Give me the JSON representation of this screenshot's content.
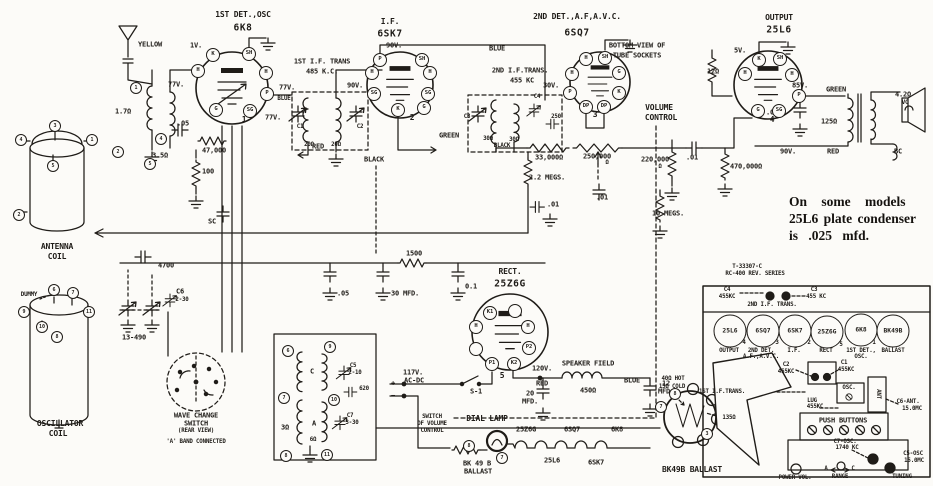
{
  "stages": {
    "det1": {
      "caption": "1ST DET.,OSC",
      "tube": "6K8",
      "num": "1"
    },
    "if1": {
      "caption": "I.F.",
      "tube": "6SK7",
      "num": "2"
    },
    "det2": {
      "caption": "2ND DET.,A.F,A.V.C.",
      "tube": "6SQ7",
      "num": "3"
    },
    "out": {
      "caption": "OUTPUT",
      "tube": "25L6",
      "num": "4"
    },
    "rect": {
      "caption": "RECT.",
      "tube": "25Z6G",
      "num": "5"
    }
  },
  "socket_note": {
    "l1": "BOTTOM VIEW OF",
    "l2": "TUBE SOCKETS"
  },
  "volts": {
    "v1": "1V.",
    "v5": "5V.",
    "v30": "30V.",
    "v77": "77V.",
    "v85": "85V.",
    "v90": "90V.",
    "v120": "120V."
  },
  "wires": {
    "yellow": "YELLOW",
    "blue": "BLUE",
    "red": "RED",
    "green": "GREEN",
    "black": "BLACK"
  },
  "parts": {
    "ant_prim": "1.7Ω",
    "ant_sec": "3.5Ω",
    "c_05": ".05",
    "r_47k": "47,000",
    "r_100": "100",
    "c_sc": "SC",
    "c_4700": "4700",
    "gang": "13-490",
    "c6": "C6",
    "c6_val": "2-30",
    "if1_name": "1ST I.F. TRANS",
    "if1_freq": "485 K.C.",
    "c1": "C1",
    "c2": "C2",
    "r_20": "20Ω",
    "if2_name": "2ND I.F.TRANS.",
    "if2_freq": "455 KC",
    "c3": "C3",
    "c4": "C4",
    "c_250": "250",
    "r_30": "30Ω",
    "r_33k": "33,000Ω",
    "pot": "250,000",
    "ohm": "Ω",
    "r_22m": "2.2 MEGS.",
    "c_01": ".01",
    "r_220k": "220,000",
    "r_10m": "10 MEGS.",
    "r_470k": "470,000Ω",
    "vol1": "VOLUME",
    "vol2": "CONTROL",
    "r_12": "12Ω",
    "c_035": ".035",
    "r_125": "125Ω",
    "vc_imp": "4.2Ω",
    "vc": "VC",
    "bc": "BC",
    "r_1500": "1500",
    "c_30mfd": "30 MFD.",
    "c_01b": "0.1",
    "field1": "SPEAKER FIELD",
    "field2": "450Ω",
    "c20_1": "20",
    "c20_2": "MFD.",
    "c12_1": "12",
    "c12_2": "MFD.",
    "s1": "S-1",
    "mains1": "117V.",
    "mains2": "AC-DC",
    "plus": "+",
    "minus": "−",
    "msw1": "SWITCH",
    "msw2": "OF VOLUME",
    "msw3": "CONTROL",
    "wind_c": "C",
    "wind_a": "A",
    "osc_3": "3Ω",
    "osc_6": "6Ω",
    "c5": "C5",
    "c5_val": "2-10",
    "c_620": "620",
    "c7": "C7",
    "c7_val": "3-30"
  },
  "wave": {
    "l1": "WAVE CHANGE",
    "l2": "SWITCH",
    "l3": "(REAR VIEW)",
    "l4": "'A' BAND CONNECTED"
  },
  "note": {
    "l1": "On some models",
    "l2": "25L6 plate condenser",
    "l3": "is .025 mfd."
  },
  "dial": {
    "label": "DIAL LAMP",
    "ballast1": "BK 49 B",
    "ballast2": "BALLAST",
    "pin_a": "8",
    "pin_b": "7"
  },
  "heater": [
    "25Z6G",
    "6SQ7",
    "6K8",
    "25L6",
    "6SK7"
  ],
  "ballast": {
    "hot": "40Ω HOT",
    "cold": "15Ω COLD",
    "res": "135Ω",
    "name": "BK49B BALLAST",
    "p7": "7",
    "p8": "8",
    "p3": "3"
  },
  "pins": {
    "det1": [
      "K",
      "SH",
      "H",
      "H",
      "P",
      "SG",
      "G"
    ],
    "if1": [
      "P",
      "SH",
      "H",
      "H",
      "SG",
      "SG",
      "K",
      "G"
    ],
    "det2": [
      "H",
      "SH",
      "H",
      "G",
      "P",
      "K",
      "DP",
      "DP"
    ],
    "out": [
      "K",
      "SH",
      "H",
      "H",
      "P",
      "G",
      "SG"
    ],
    "rect": [
      "K1",
      "H",
      "H",
      "P2",
      "P1",
      "K2"
    ]
  },
  "coil_pins": {
    "ant": [
      "1",
      "2",
      "4",
      "5"
    ],
    "osc": [
      "6",
      "9",
      "7",
      "10",
      "11",
      "8"
    ]
  },
  "pictorials": {
    "antenna": {
      "l1": "ANTENNA",
      "l2": "COIL",
      "pins": [
        "3",
        "4",
        "1",
        "5",
        "2"
      ]
    },
    "oscillator": {
      "l1": "OSCILLATOR",
      "l2": "COIL",
      "dummy": "DUMMY",
      "pins": [
        "6",
        "7",
        "9",
        "11",
        "10",
        "8"
      ]
    }
  },
  "chassis": {
    "model1": "T-33307-C",
    "model2": "RC-400 REV. SERIES",
    "c4": "C4",
    "c4f": "455KC",
    "c3": "C3",
    "c3f": "455 KC",
    "if2": "2ND I.F. TRANS.",
    "sockets": [
      {
        "tube": "25L6",
        "num": "4",
        "c1": "OUTPUT",
        "c2": ""
      },
      {
        "tube": "6SQ7",
        "num": "3",
        "c1": "2ND DET.",
        "c2": "A.F.,A.V.C."
      },
      {
        "tube": "6SK7",
        "num": "2",
        "c1": "I.F.",
        "c2": ""
      },
      {
        "tube": "25Z6G",
        "num": "5",
        "c1": "RECT",
        "c2": ""
      },
      {
        "tube": "6K8",
        "num": "1",
        "c1": "1ST DET.,",
        "c2": "OSC."
      },
      {
        "tube": "BK49B",
        "num": "",
        "c1": "BALLAST",
        "c2": ""
      }
    ],
    "c2": "C2",
    "c2f": "455KC",
    "c1": "C1",
    "c1f": "455KC",
    "if1": "1ST I.F.TRANS.",
    "lug": "LUG",
    "lugf": "455KC",
    "osc": "OSC.",
    "ant": "ANT",
    "c6": "C6-ANT.",
    "c6f": "15.0MC",
    "push": "PUSH BUTTONS",
    "c7": "C7-OSC.",
    "c7f": "1740 KC",
    "c5": "C5-OSC",
    "c5f": "15.0MC",
    "power": "POWER-VOL.",
    "range": "RANGE",
    "range_a": "A",
    "range_c": "C",
    "tuning": "TUNING"
  }
}
